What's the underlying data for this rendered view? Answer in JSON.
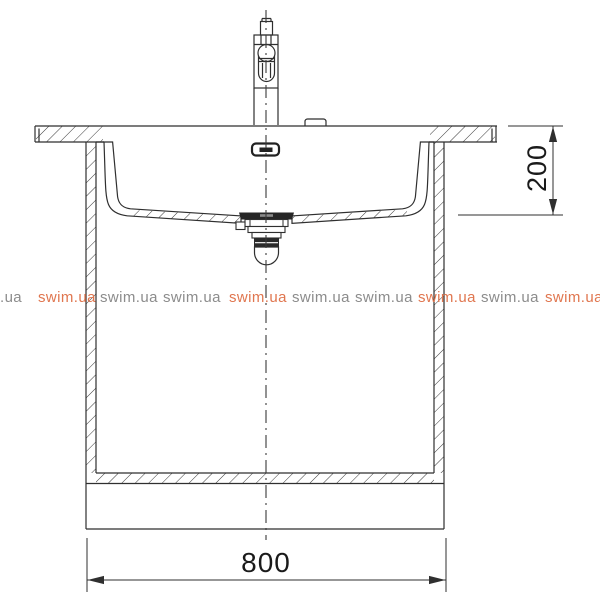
{
  "dims": {
    "width": "800",
    "depth": "200"
  },
  "watermarks": [
    {
      "text": ".ua",
      "cls": "wm wm-gray"
    },
    {
      "text": "swim.ua",
      "cls": "wm wm-orange"
    },
    {
      "text": "swim.ua",
      "cls": "wm wm-gray"
    },
    {
      "text": "swim.ua",
      "cls": "wm wm-gray"
    },
    {
      "text": "swim.ua",
      "cls": "wm wm-orange"
    },
    {
      "text": "swim.ua",
      "cls": "wm wm-gray"
    },
    {
      "text": "swim.ua",
      "cls": "wm wm-gray"
    },
    {
      "text": "swim.ua",
      "cls": "wm wm-orange"
    },
    {
      "text": "swim.ua",
      "cls": "wm wm-gray"
    },
    {
      "text": "swim.ua",
      "cls": "wm wm-orange"
    }
  ],
  "colors": {
    "line": "#2f2f2f",
    "dimension_text": "#1a1a1a",
    "watermark_gray": "#8c8c8c",
    "watermark_orange": "#e0764f",
    "background": "#ffffff"
  }
}
